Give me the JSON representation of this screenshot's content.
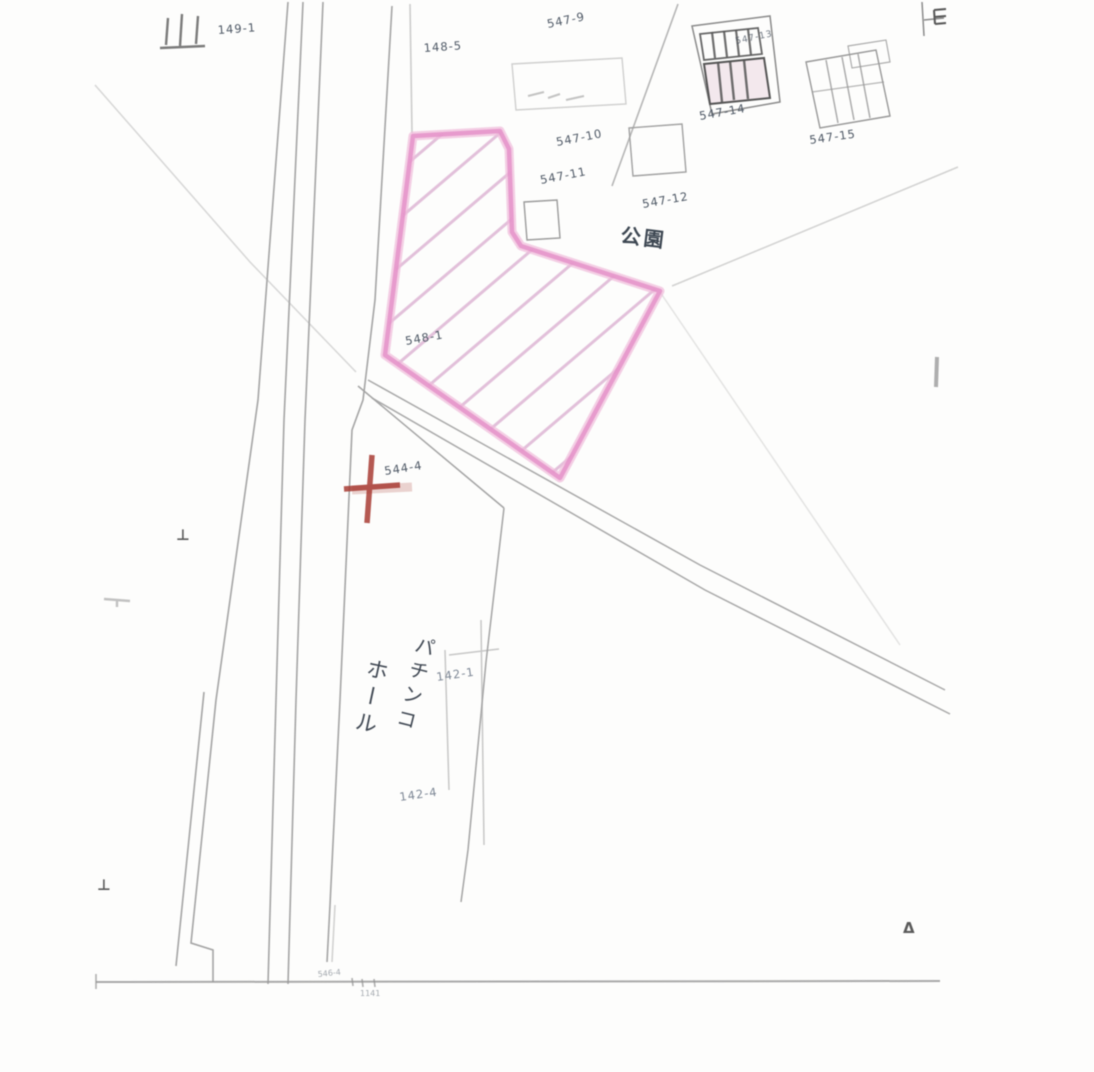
{
  "map": {
    "type": "cadastral-sketch",
    "colors": {
      "background": "#fdfdfc",
      "line": "#a0a0a0",
      "label": "#4e5865",
      "highlight_outline": "#e38fc7",
      "highlight_hatch": "#d4a0c8",
      "marker_cross": "#a83c34"
    },
    "parcels": {
      "p149_1": "149-1",
      "p148_5": "148-5",
      "p547_9": "547-9",
      "p547_10": "547-10",
      "p547_11": "547-11",
      "p547_12": "547-12",
      "p547_13": "547-13",
      "p547_14": "547-14",
      "p547_15": "547-15",
      "p548_1": "548-1",
      "p544_4": "544-4",
      "p142_1": "142-1",
      "p142_4": "142-4",
      "p546_4": "546-4"
    },
    "annotations": {
      "park": "公園",
      "building_vertical_text_col1": "パチンコ",
      "building_vertical_text_col2": "ホール",
      "bench_mark": "⊥",
      "triangle_point": "Δ",
      "bottom_tick_text": "1141"
    }
  }
}
